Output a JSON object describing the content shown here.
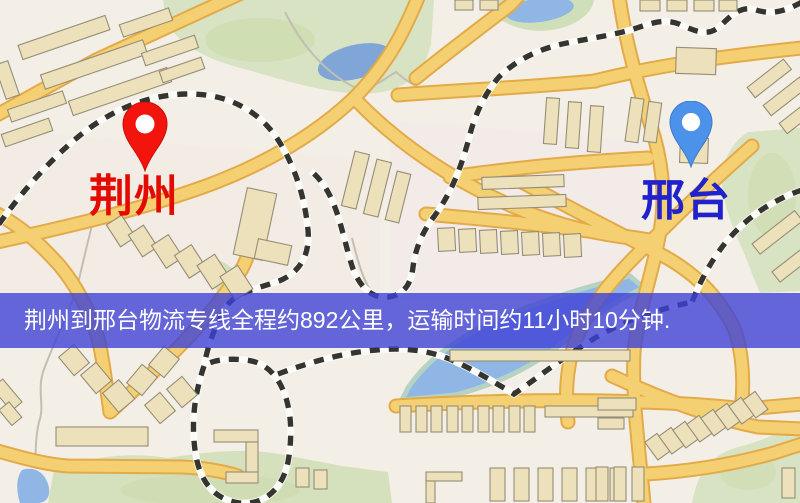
{
  "map": {
    "markers": [
      {
        "id": "origin",
        "label": "荆州",
        "pin_color": "#f3150d",
        "pin_stroke": "#c50f06",
        "label_color": "#e30b00"
      },
      {
        "id": "destination",
        "label": "邢台",
        "pin_color": "#4d92ea",
        "pin_stroke": "#3a78c8",
        "label_color": "#2122cb"
      }
    ]
  },
  "banner": {
    "text": "荆州到邢台物流专线全程约892公里，运输时间约11小时10分钟.",
    "background_color": "#4A4FD8",
    "text_color": "#ffffff"
  },
  "route_info": {
    "origin": "荆州",
    "destination": "邢台",
    "service": "物流专线",
    "distance_text": "约892公里",
    "duration_text": "约11小时10分钟"
  },
  "map_colors": {
    "background": "#f4efe6",
    "road_fill": "#f5d072",
    "road_casing": "#e2aa48",
    "green_area": "#d8e3c3",
    "water": "#8fb6e4",
    "building": "#ece1ba",
    "railway": "#35342f"
  }
}
